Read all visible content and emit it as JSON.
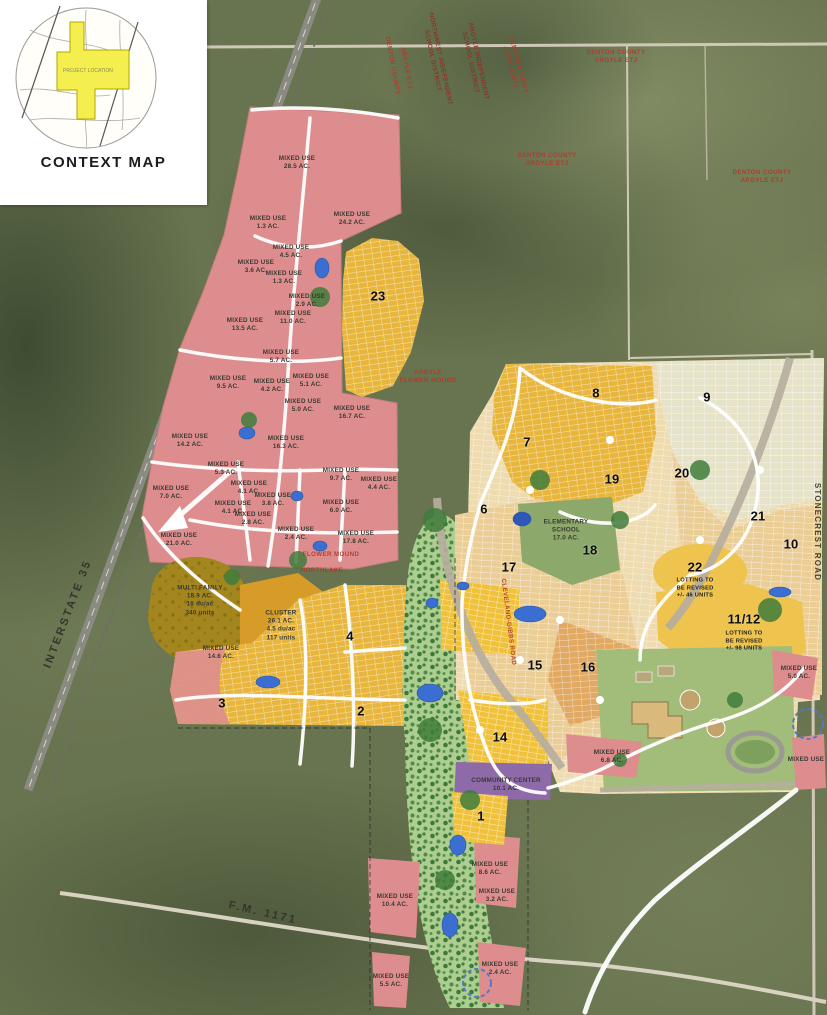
{
  "context_map": {
    "title": "CONTEXT MAP",
    "project_label": "PROJECT LOCATION"
  },
  "map": {
    "parcels": [
      {
        "name": "mixed-use-28-5",
        "lines": [
          "MIXED USE",
          "28.5 AC."
        ],
        "x": 297,
        "y": 163
      },
      {
        "name": "mixed-use-24-2",
        "lines": [
          "MIXED USE",
          "24.2 AC."
        ],
        "x": 352,
        "y": 219
      },
      {
        "name": "mixed-use-1-3a",
        "lines": [
          "MIXED USE",
          "1.3 AC."
        ],
        "x": 268,
        "y": 223
      },
      {
        "name": "mixed-use-4-5",
        "lines": [
          "MIXED USE",
          "4.5 AC."
        ],
        "x": 291,
        "y": 252
      },
      {
        "name": "mixed-use-3-6",
        "lines": [
          "MIXED USE",
          "3.6 AC."
        ],
        "x": 256,
        "y": 267
      },
      {
        "name": "mixed-use-1-3b",
        "lines": [
          "MIXED USE",
          "1.3 AC."
        ],
        "x": 284,
        "y": 278
      },
      {
        "name": "mixed-use-2-9",
        "lines": [
          "MIXED USE",
          "2.9 AC."
        ],
        "x": 307,
        "y": 301
      },
      {
        "name": "mixed-use-13-5",
        "lines": [
          "MIXED USE",
          "13.5 AC."
        ],
        "x": 245,
        "y": 325
      },
      {
        "name": "mixed-use-11-0",
        "lines": [
          "MIXED USE",
          "11.0 AC."
        ],
        "x": 293,
        "y": 318
      },
      {
        "name": "mixed-use-5-7",
        "lines": [
          "MIXED USE",
          "5.7 AC."
        ],
        "x": 281,
        "y": 357
      },
      {
        "name": "mixed-use-9-5",
        "lines": [
          "MIXED USE",
          "9.5 AC."
        ],
        "x": 228,
        "y": 383
      },
      {
        "name": "mixed-use-4-2",
        "lines": [
          "MIXED USE",
          "4.2 AC."
        ],
        "x": 272,
        "y": 386
      },
      {
        "name": "mixed-use-5-1",
        "lines": [
          "MIXED USE",
          "5.1 AC."
        ],
        "x": 311,
        "y": 381
      },
      {
        "name": "mixed-use-5-0a",
        "lines": [
          "MIXED USE",
          "5.0 AC."
        ],
        "x": 303,
        "y": 406
      },
      {
        "name": "mixed-use-16-7",
        "lines": [
          "MIXED USE",
          "16.7 AC."
        ],
        "x": 352,
        "y": 413
      },
      {
        "name": "mixed-use-14-2",
        "lines": [
          "MIXED USE",
          "14.2 AC."
        ],
        "x": 190,
        "y": 441
      },
      {
        "name": "mixed-use-16-3",
        "lines": [
          "MIXED USE",
          "16.3 AC."
        ],
        "x": 286,
        "y": 443
      },
      {
        "name": "mixed-use-5-3",
        "lines": [
          "MIXED USE",
          "5.3 AC."
        ],
        "x": 226,
        "y": 469
      },
      {
        "name": "mixed-use-9-7",
        "lines": [
          "MIXED USE",
          "9.7 AC."
        ],
        "x": 341,
        "y": 475
      },
      {
        "name": "mixed-use-4-4",
        "lines": [
          "MIXED USE",
          "4.4 AC."
        ],
        "x": 379,
        "y": 484
      },
      {
        "name": "mixed-use-4-1a",
        "lines": [
          "MIXED USE",
          "4.1 AC."
        ],
        "x": 249,
        "y": 488
      },
      {
        "name": "mixed-use-7-0",
        "lines": [
          "MIXED USE",
          "7.0 AC."
        ],
        "x": 171,
        "y": 493
      },
      {
        "name": "mixed-use-3-8",
        "lines": [
          "MIXED USE",
          "3.8 AC."
        ],
        "x": 273,
        "y": 500
      },
      {
        "name": "mixed-use-4-1b",
        "lines": [
          "MIXED USE",
          "4.1 AC."
        ],
        "x": 233,
        "y": 508
      },
      {
        "name": "mixed-use-2-8",
        "lines": [
          "MIXED USE",
          "2.8 AC."
        ],
        "x": 253,
        "y": 519
      },
      {
        "name": "mixed-use-6-0",
        "lines": [
          "MIXED USE",
          "6.0 AC."
        ],
        "x": 341,
        "y": 507
      },
      {
        "name": "mixed-use-2-4a",
        "lines": [
          "MIXED USE",
          "2.4 AC."
        ],
        "x": 296,
        "y": 534
      },
      {
        "name": "mixed-use-21-0",
        "lines": [
          "MIXED USE",
          "21.0 AC."
        ],
        "x": 179,
        "y": 540
      },
      {
        "name": "mixed-use-17-8",
        "lines": [
          "MIXED USE",
          "17.8 AC."
        ],
        "x": 356,
        "y": 538
      },
      {
        "name": "multi-family",
        "lines": [
          "MULTI FAMILY",
          "18.9 AC.",
          "18 du/ac",
          "340 units"
        ],
        "x": 200,
        "y": 601
      },
      {
        "name": "cluster",
        "lines": [
          "CLUSTER",
          "26.1 AC.",
          "4.5 du/ac",
          "117 units"
        ],
        "x": 281,
        "y": 626
      },
      {
        "name": "mixed-use-14-6",
        "lines": [
          "MIXED USE",
          "14.6 AC."
        ],
        "x": 221,
        "y": 653
      },
      {
        "name": "elementary-school",
        "lines": [
          "ELEMENTARY",
          "SCHOOL",
          "17.0 AC."
        ],
        "x": 566,
        "y": 531
      },
      {
        "name": "community-center",
        "lines": [
          "COMMUNITY CENTER",
          "10.1 AC."
        ],
        "x": 506,
        "y": 785
      },
      {
        "name": "mixed-use-6-8",
        "lines": [
          "MIXED USE",
          "6.8 AC."
        ],
        "x": 612,
        "y": 757
      },
      {
        "name": "mixed-use-5-0b",
        "lines": [
          "MIXED USE",
          "5.0 AC."
        ],
        "x": 799,
        "y": 673
      },
      {
        "name": "mixed-use-8-6",
        "lines": [
          "MIXED USE",
          "8.6 AC."
        ],
        "x": 490,
        "y": 869
      },
      {
        "name": "mixed-use-3-2",
        "lines": [
          "MIXED USE",
          "3.2 AC."
        ],
        "x": 497,
        "y": 896
      },
      {
        "name": "mixed-use-10-4",
        "lines": [
          "MIXED USE",
          "10.4 AC."
        ],
        "x": 395,
        "y": 901
      },
      {
        "name": "mixed-use-5-5",
        "lines": [
          "MIXED USE",
          "5.5 AC."
        ],
        "x": 391,
        "y": 981
      },
      {
        "name": "mixed-use-2-4b",
        "lines": [
          "MIXED USE",
          "2.4 AC."
        ],
        "x": 500,
        "y": 969
      },
      {
        "name": "mixed-use-se",
        "lines": [
          "MIXED USE"
        ],
        "x": 806,
        "y": 760
      },
      {
        "name": "phase-22-note",
        "lines": [
          "LOTTING TO",
          "BE REVISED",
          "+/- 46 UNITS"
        ],
        "x": 695,
        "y": 589,
        "cls": "sub"
      },
      {
        "name": "phase-11-12-note",
        "lines": [
          "LOTTING TO",
          "BE REVISED",
          "+/- 98 UNITS"
        ],
        "x": 744,
        "y": 642,
        "cls": "sub"
      }
    ],
    "phases": [
      {
        "name": "phase-1",
        "lines": [
          "1"
        ],
        "x": 481,
        "y": 817
      },
      {
        "name": "phase-2",
        "lines": [
          "2"
        ],
        "x": 361,
        "y": 712
      },
      {
        "name": "phase-3",
        "lines": [
          "3"
        ],
        "x": 222,
        "y": 704
      },
      {
        "name": "phase-4",
        "lines": [
          "4"
        ],
        "x": 350,
        "y": 637
      },
      {
        "name": "phase-6",
        "lines": [
          "6"
        ],
        "x": 484,
        "y": 510
      },
      {
        "name": "phase-7",
        "lines": [
          "7"
        ],
        "x": 527,
        "y": 443
      },
      {
        "name": "phase-8",
        "lines": [
          "8"
        ],
        "x": 596,
        "y": 394
      },
      {
        "name": "phase-9",
        "lines": [
          "9"
        ],
        "x": 707,
        "y": 398
      },
      {
        "name": "phase-10",
        "lines": [
          "10"
        ],
        "x": 791,
        "y": 545
      },
      {
        "name": "phase-11-12",
        "lines": [
          "11/12"
        ],
        "x": 744,
        "y": 620
      },
      {
        "name": "phase-14",
        "lines": [
          "14"
        ],
        "x": 500,
        "y": 738
      },
      {
        "name": "phase-15",
        "lines": [
          "15"
        ],
        "x": 535,
        "y": 666
      },
      {
        "name": "phase-16",
        "lines": [
          "16"
        ],
        "x": 588,
        "y": 668
      },
      {
        "name": "phase-17",
        "lines": [
          "17"
        ],
        "x": 509,
        "y": 568
      },
      {
        "name": "phase-18",
        "lines": [
          "18"
        ],
        "x": 590,
        "y": 551
      },
      {
        "name": "phase-19",
        "lines": [
          "19"
        ],
        "x": 612,
        "y": 480
      },
      {
        "name": "phase-20",
        "lines": [
          "20"
        ],
        "x": 682,
        "y": 474
      },
      {
        "name": "phase-21",
        "lines": [
          "21"
        ],
        "x": 758,
        "y": 517
      },
      {
        "name": "phase-22",
        "lines": [
          "22"
        ],
        "x": 695,
        "y": 568
      },
      {
        "name": "phase-23",
        "lines": [
          "23"
        ],
        "x": 378,
        "y": 297
      }
    ],
    "annotations": [
      {
        "name": "isd-boundary-label-1",
        "lines": [
          "NORTHWEST INDEPENDENT",
          "SCHOOL DISTRICT"
        ],
        "x": 436,
        "y": 60,
        "rot": 78,
        "cls": "red dk"
      },
      {
        "name": "isd-boundary-label-2",
        "lines": [
          "ARGYLE INDEPENDENT",
          "SCHOOL DISTRICT"
        ],
        "x": 474,
        "y": 62,
        "rot": 78,
        "cls": "red dk"
      },
      {
        "name": "etj-label-1",
        "lines": [
          "DENTON COUNTY",
          "ARGYLE ETJ"
        ],
        "x": 514,
        "y": 66,
        "rot": 75,
        "cls": "red"
      },
      {
        "name": "etj-label-2",
        "lines": [
          "DENTON COUNTY",
          "ARGYLE ETJ"
        ],
        "x": 547,
        "y": 160,
        "cls": "red"
      },
      {
        "name": "etj-label-3",
        "lines": [
          "DENTON COUNTY",
          "ARGYLE ETJ"
        ],
        "x": 616,
        "y": 57,
        "cls": "red"
      },
      {
        "name": "etj-label-4",
        "lines": [
          "DENTON COUNTY",
          "ARGYLE ETJ"
        ],
        "x": 762,
        "y": 177,
        "cls": "red"
      },
      {
        "name": "county-label-5",
        "lines": [
          "DENTON COUNTY"
        ],
        "x": 392,
        "y": 66,
        "rot": 80,
        "cls": "red"
      },
      {
        "name": "county-label-6",
        "lines": [
          "ARGYLE ETJ"
        ],
        "x": 406,
        "y": 68,
        "rot": 80,
        "cls": "red"
      },
      {
        "name": "boundary-flower-mound",
        "lines": [
          "FLOWER MOUND"
        ],
        "x": 331,
        "y": 555,
        "cls": "red"
      },
      {
        "name": "boundary-northlake",
        "lines": [
          "NORTHLAKE"
        ],
        "x": 322,
        "y": 571,
        "cls": "red"
      },
      {
        "name": "boundary-argyle",
        "lines": [
          "ARGYLE",
          "FLOWER MOUND"
        ],
        "x": 428,
        "y": 377,
        "cls": "red"
      },
      {
        "name": "cleveland-gibbs-road-label",
        "lines": [
          "CLEVELAND-GIBBS ROAD"
        ],
        "x": 508,
        "y": 622,
        "rot": 83,
        "cls": "red"
      }
    ],
    "road_labels": [
      {
        "name": "interstate-35-label",
        "lines": [
          "INTERSTATE 35"
        ],
        "x": 68,
        "y": 614,
        "rot": -69,
        "cls": "road"
      },
      {
        "name": "fm-1171-label",
        "lines": [
          "F.M. 1171"
        ],
        "x": 263,
        "y": 913,
        "rot": 13,
        "cls": "road"
      },
      {
        "name": "stonecrest-road-label",
        "lines": [
          "STONECREST ROAD"
        ],
        "x": 817,
        "y": 532,
        "rot": 90,
        "cls": "road sm"
      }
    ]
  }
}
